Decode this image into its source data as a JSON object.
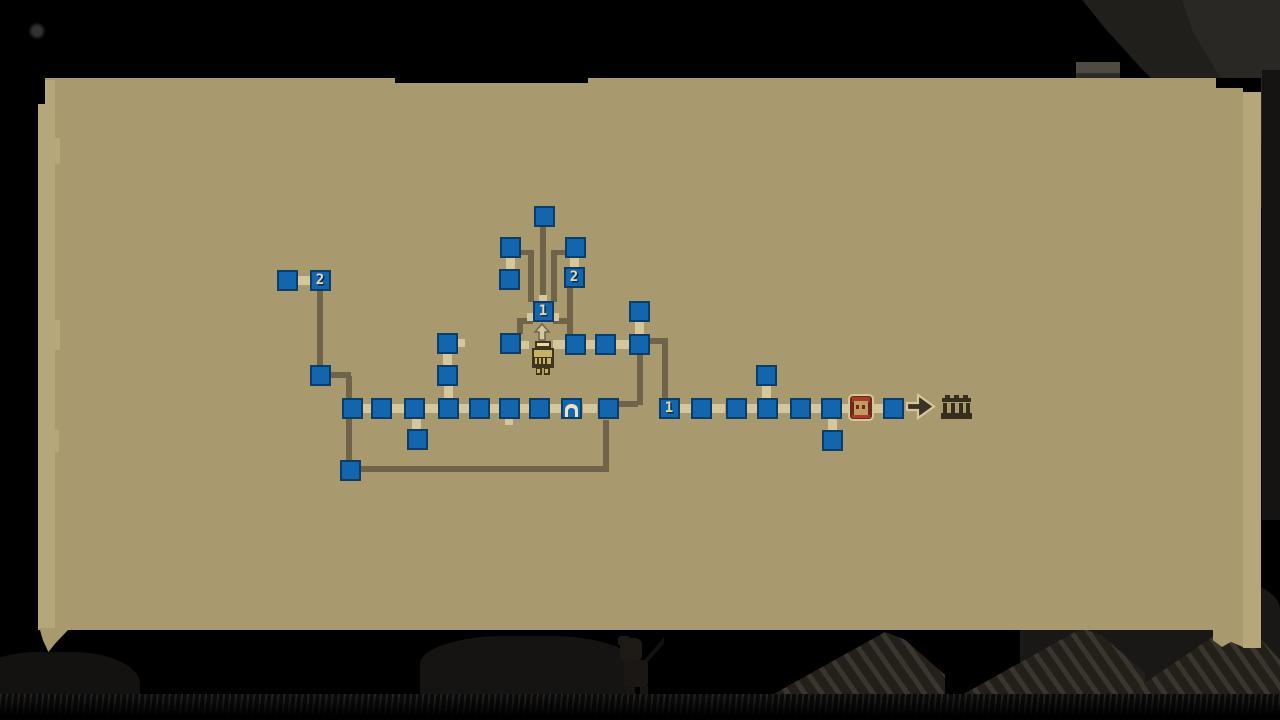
{
  "screen": {
    "description": "dungeon mine map parchment overlay",
    "room_labels_present": [
      "1",
      "2"
    ]
  },
  "colors": {
    "background": "#000000",
    "parchment": "#a89a6e",
    "parchment_edge": "#b5a77a",
    "node_fill": "#1366ae",
    "node_border": "#0c3d68",
    "path": "#6f6449",
    "cream": "#d5c79c",
    "label": "#ead9a2",
    "label_shadow": "#0a2c50",
    "idol_gold": "#c6b166",
    "idol_dark": "#3e351c",
    "portrait_maroon": "#6d2a1c",
    "portrait_hair": "#a83c24",
    "portrait_face": "#c29b63",
    "arrow_dark": "#3a3222",
    "gate_dark": "#352e1e"
  },
  "map": {
    "rooms": [
      {
        "x": 544,
        "y": 216,
        "label": ""
      },
      {
        "x": 510,
        "y": 247,
        "label": ""
      },
      {
        "x": 575,
        "y": 247,
        "label": ""
      },
      {
        "x": 509,
        "y": 279,
        "label": ""
      },
      {
        "x": 574,
        "y": 277,
        "label": "2"
      },
      {
        "x": 543,
        "y": 311,
        "label": "1"
      },
      {
        "x": 510,
        "y": 343,
        "label": ""
      },
      {
        "x": 575,
        "y": 344,
        "label": ""
      },
      {
        "x": 605,
        "y": 344,
        "label": ""
      },
      {
        "x": 639,
        "y": 344,
        "label": ""
      },
      {
        "x": 639,
        "y": 311,
        "label": ""
      },
      {
        "x": 287,
        "y": 280,
        "label": ""
      },
      {
        "x": 320,
        "y": 280,
        "label": "2"
      },
      {
        "x": 320,
        "y": 375,
        "label": ""
      },
      {
        "x": 352,
        "y": 408,
        "label": ""
      },
      {
        "x": 381,
        "y": 408,
        "label": ""
      },
      {
        "x": 414,
        "y": 408,
        "label": ""
      },
      {
        "x": 448,
        "y": 408,
        "label": ""
      },
      {
        "x": 479,
        "y": 408,
        "label": ""
      },
      {
        "x": 509,
        "y": 408,
        "label": ""
      },
      {
        "x": 539,
        "y": 408,
        "label": ""
      },
      {
        "x": 571,
        "y": 408,
        "label": "door"
      },
      {
        "x": 608,
        "y": 408,
        "label": ""
      },
      {
        "x": 447,
        "y": 343,
        "label": ""
      },
      {
        "x": 447,
        "y": 375,
        "label": ""
      },
      {
        "x": 417,
        "y": 439,
        "label": ""
      },
      {
        "x": 350,
        "y": 470,
        "label": ""
      },
      {
        "x": 669,
        "y": 408,
        "label": "1"
      },
      {
        "x": 701,
        "y": 408,
        "label": ""
      },
      {
        "x": 736,
        "y": 408,
        "label": ""
      },
      {
        "x": 767,
        "y": 408,
        "label": ""
      },
      {
        "x": 800,
        "y": 408,
        "label": ""
      },
      {
        "x": 831,
        "y": 408,
        "label": ""
      },
      {
        "x": 893,
        "y": 408,
        "label": ""
      },
      {
        "x": 766,
        "y": 375,
        "label": ""
      },
      {
        "x": 832,
        "y": 440,
        "label": ""
      }
    ],
    "connectors": [
      {
        "x": 304,
        "y": 280,
        "dir": "h"
      },
      {
        "x": 510,
        "y": 263,
        "dir": "v"
      },
      {
        "x": 574,
        "y": 262,
        "dir": "v"
      },
      {
        "x": 639,
        "y": 328,
        "dir": "v"
      },
      {
        "x": 590,
        "y": 344,
        "dir": "h"
      },
      {
        "x": 622,
        "y": 344,
        "dir": "h"
      },
      {
        "x": 560,
        "y": 344,
        "dir": "h"
      },
      {
        "x": 525,
        "y": 345,
        "dir": "s"
      },
      {
        "x": 447,
        "y": 359,
        "dir": "v"
      },
      {
        "x": 448,
        "y": 391,
        "dir": "v"
      },
      {
        "x": 461,
        "y": 343,
        "dir": "s"
      },
      {
        "x": 366,
        "y": 408,
        "dir": "h"
      },
      {
        "x": 398,
        "y": 408,
        "dir": "h"
      },
      {
        "x": 431,
        "y": 408,
        "dir": "h"
      },
      {
        "x": 464,
        "y": 408,
        "dir": "h"
      },
      {
        "x": 494,
        "y": 408,
        "dir": "h"
      },
      {
        "x": 524,
        "y": 408,
        "dir": "h"
      },
      {
        "x": 555,
        "y": 408,
        "dir": "h"
      },
      {
        "x": 590,
        "y": 408,
        "dir": "h"
      },
      {
        "x": 509,
        "y": 421,
        "dir": "s"
      },
      {
        "x": 416,
        "y": 424,
        "dir": "v"
      },
      {
        "x": 685,
        "y": 408,
        "dir": "h"
      },
      {
        "x": 718,
        "y": 408,
        "dir": "h"
      },
      {
        "x": 752,
        "y": 408,
        "dir": "h"
      },
      {
        "x": 784,
        "y": 408,
        "dir": "h"
      },
      {
        "x": 816,
        "y": 408,
        "dir": "h"
      },
      {
        "x": 845,
        "y": 408,
        "dir": "h"
      },
      {
        "x": 878,
        "y": 408,
        "dir": "h"
      },
      {
        "x": 766,
        "y": 391,
        "dir": "v"
      },
      {
        "x": 832,
        "y": 424,
        "dir": "v"
      },
      {
        "x": 543,
        "y": 299,
        "dir": "s"
      },
      {
        "x": 531,
        "y": 317,
        "dir": "s"
      },
      {
        "x": 555,
        "y": 317,
        "dir": "s"
      }
    ],
    "paths": [
      {
        "x": 317,
        "y": 291,
        "w": 6,
        "h": 77
      },
      {
        "x": 323,
        "y": 372,
        "w": 28,
        "h": 6
      },
      {
        "x": 346,
        "y": 376,
        "w": 6,
        "h": 86
      },
      {
        "x": 354,
        "y": 466,
        "w": 255,
        "h": 6
      },
      {
        "x": 603,
        "y": 420,
        "w": 6,
        "h": 52
      },
      {
        "x": 540,
        "y": 227,
        "w": 6,
        "h": 76
      },
      {
        "x": 520,
        "y": 250,
        "w": 14,
        "h": 5
      },
      {
        "x": 528,
        "y": 255,
        "w": 6,
        "h": 47
      },
      {
        "x": 551,
        "y": 250,
        "w": 14,
        "h": 5
      },
      {
        "x": 551,
        "y": 255,
        "w": 6,
        "h": 47
      },
      {
        "x": 517,
        "y": 318,
        "w": 16,
        "h": 6
      },
      {
        "x": 517,
        "y": 318,
        "w": 6,
        "h": 16
      },
      {
        "x": 553,
        "y": 318,
        "w": 16,
        "h": 6
      },
      {
        "x": 567,
        "y": 288,
        "w": 6,
        "h": 46
      },
      {
        "x": 637,
        "y": 355,
        "w": 6,
        "h": 50
      },
      {
        "x": 618,
        "y": 401,
        "w": 20,
        "h": 6
      },
      {
        "x": 650,
        "y": 338,
        "w": 18,
        "h": 6
      },
      {
        "x": 662,
        "y": 338,
        "w": 6,
        "h": 60
      }
    ],
    "icons": [
      {
        "name": "ascend-arrow-icon",
        "x": 533,
        "y": 323,
        "w": 18,
        "h": 18
      },
      {
        "name": "golden-idol-icon",
        "x": 529,
        "y": 341,
        "w": 28,
        "h": 34
      },
      {
        "name": "peasant-portrait-icon",
        "x": 848,
        "y": 394,
        "w": 26,
        "h": 27
      },
      {
        "name": "exit-arrow-icon",
        "x": 905,
        "y": 392,
        "w": 31,
        "h": 29
      },
      {
        "name": "gate-icon",
        "x": 941,
        "y": 395,
        "w": 31,
        "h": 25
      }
    ]
  }
}
